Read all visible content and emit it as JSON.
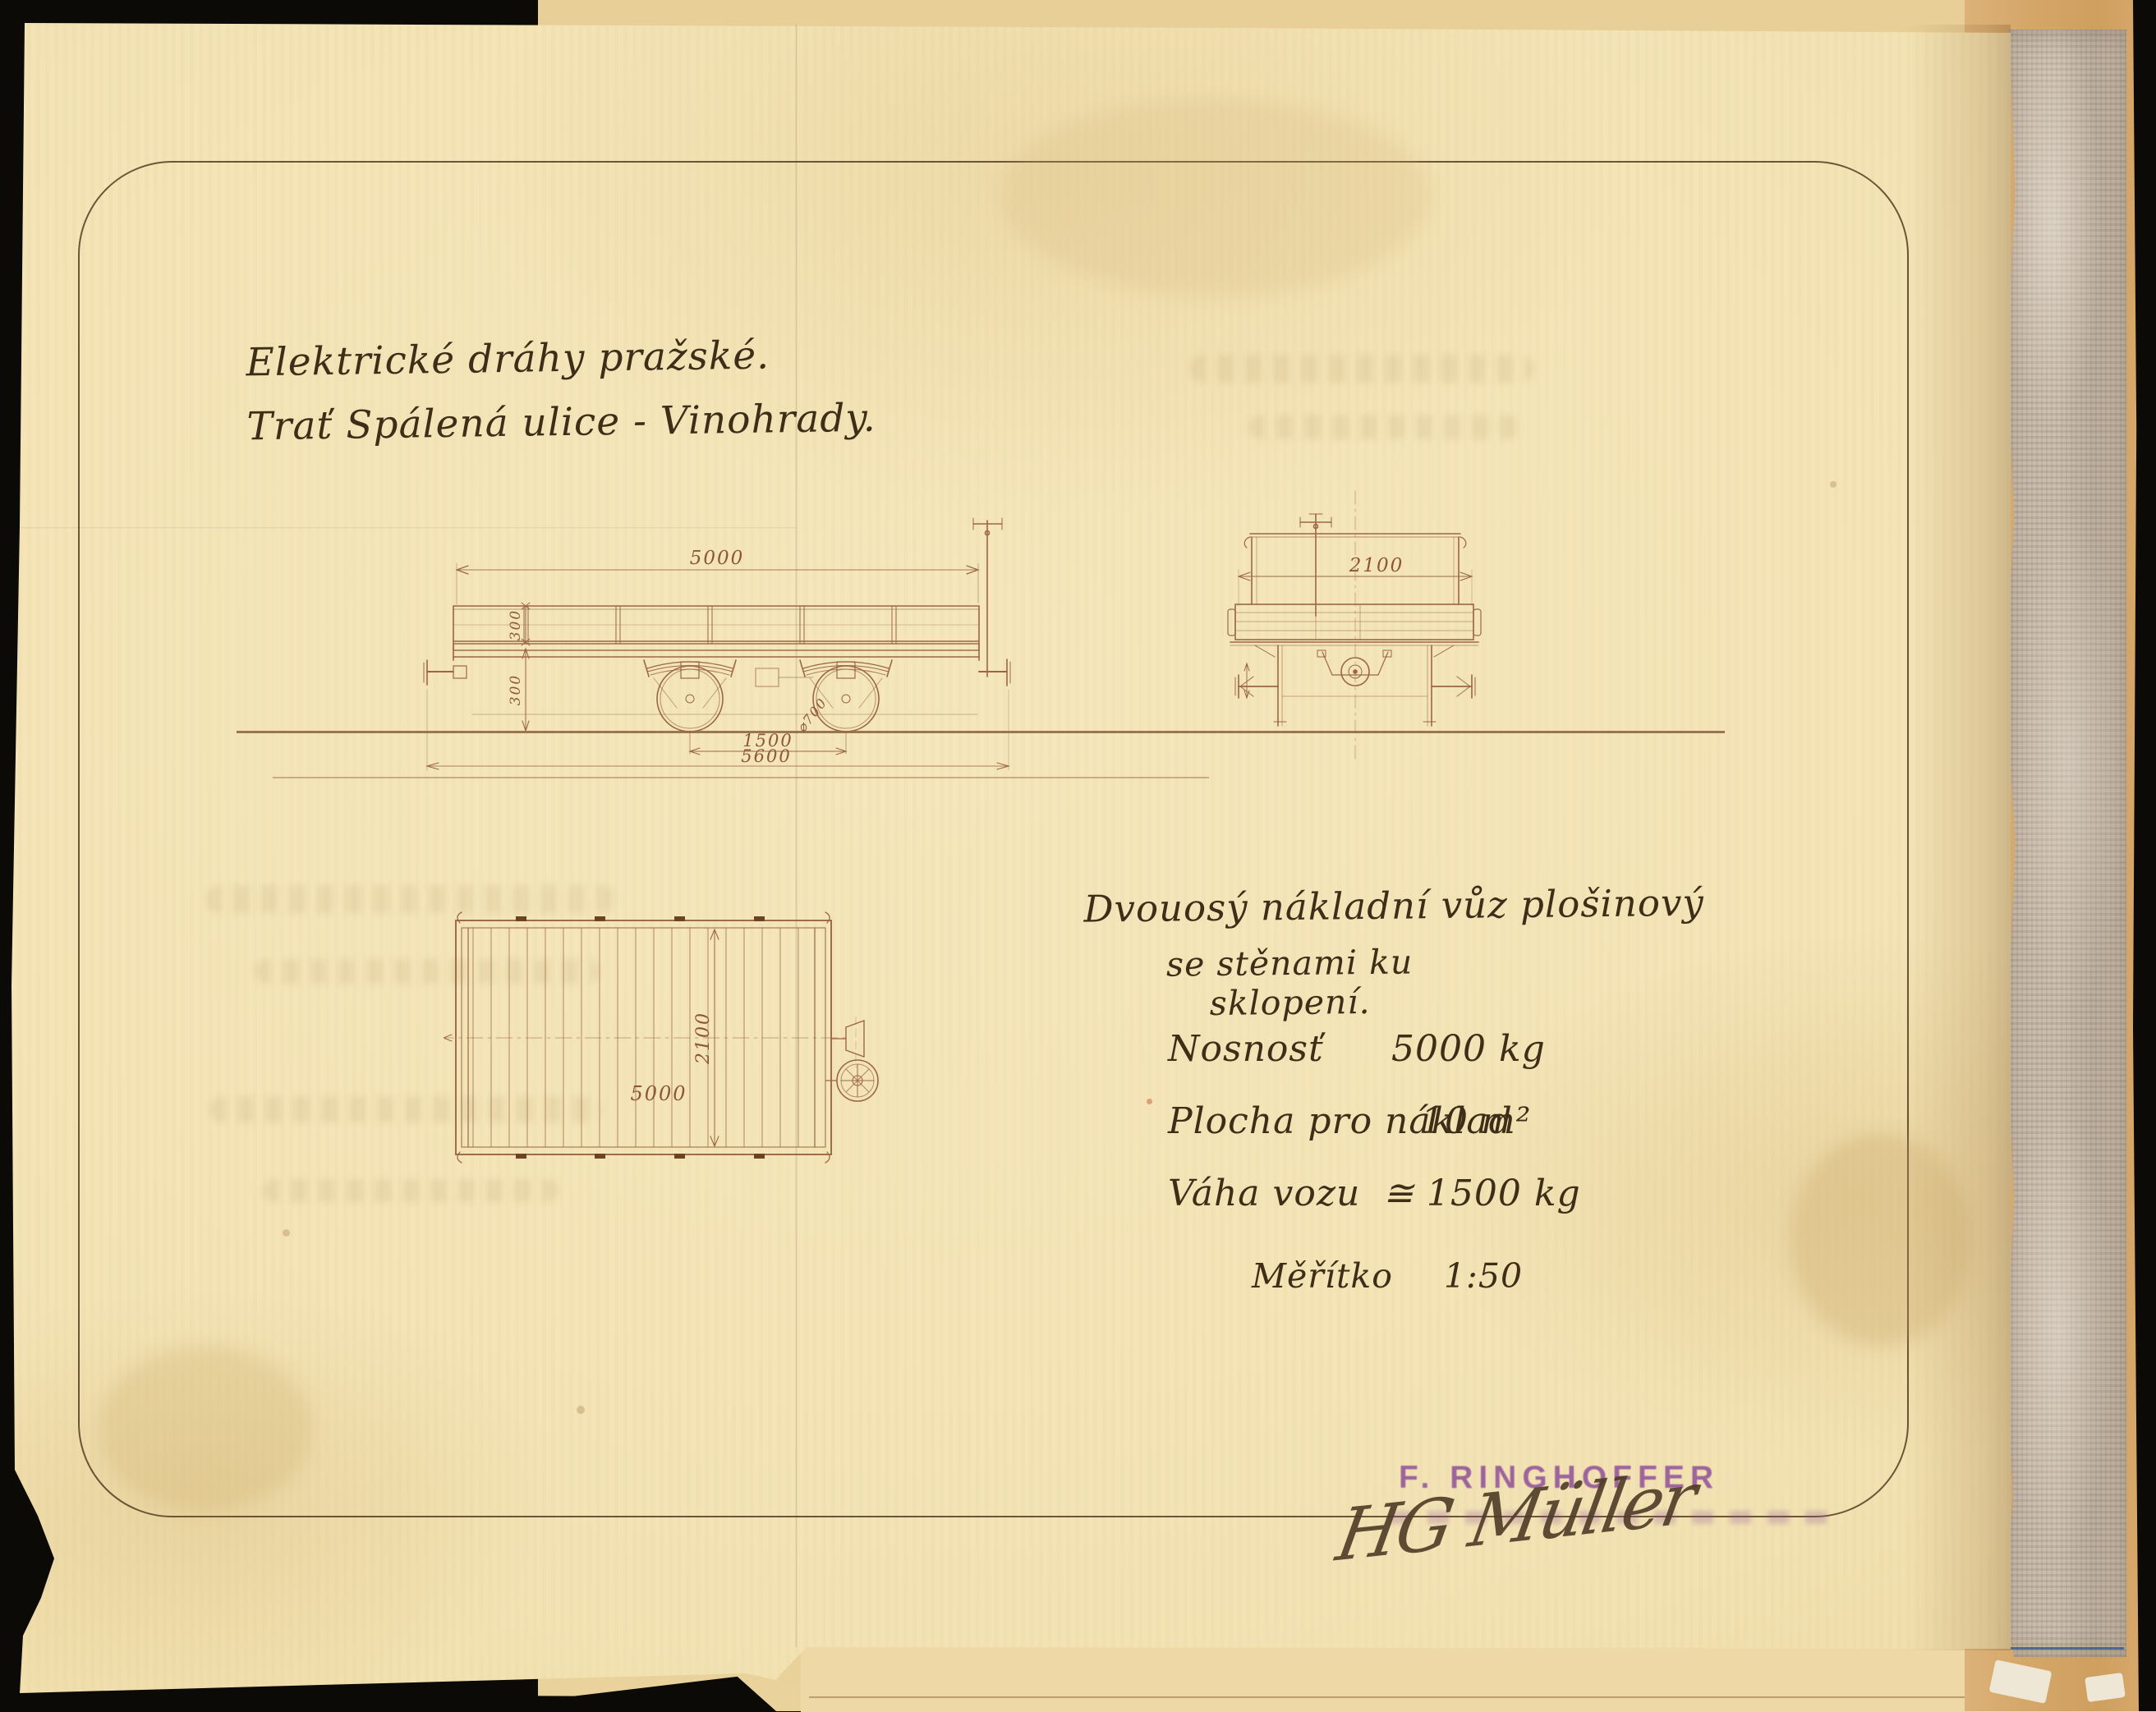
{
  "header": {
    "line1": "Elektrické dráhy pražské.",
    "line2": "Trať Spálená ulice - Vinohrady."
  },
  "description": {
    "line1": "Dvouosý nákladní vůz plošinový",
    "line2": "se stěnami ku sklopení."
  },
  "specs": {
    "rows": [
      {
        "label": "Nosnosť",
        "value": "5000 kg"
      },
      {
        "label": "Plocha pro náklad",
        "value": "10 m²"
      },
      {
        "label": "Váha vozu",
        "value": "≅ 1500 kg"
      }
    ],
    "scale_label": "Měřítko",
    "scale_value": "1:50"
  },
  "stamp": {
    "line1": "F. RINGHOFFER"
  },
  "signature": {
    "text": "HG Müller"
  },
  "drawings": {
    "side_view": {
      "dim_length": "5000",
      "dim_wall_height": "300",
      "dim_frame_height": "300",
      "dim_wheel_diameter": "⌀700",
      "dim_wheelbase": "1500",
      "dim_length_over_buffers": "5600"
    },
    "end_view": {
      "dim_width": "2100"
    },
    "plan_view": {
      "dim_length": "5000",
      "dim_width": "2100"
    }
  },
  "colors": {
    "paper": "#f3e4b6",
    "back_paper": "#e5cd93",
    "binding_paper": "#d4a668",
    "cloth": "#c6b7a8",
    "ink_drawing": "#9b6743",
    "ink_text": "#3e2e18",
    "stamp_purple": "#8b4a97",
    "blue_line": "#3e5d8e",
    "background": "#0c0a07"
  }
}
